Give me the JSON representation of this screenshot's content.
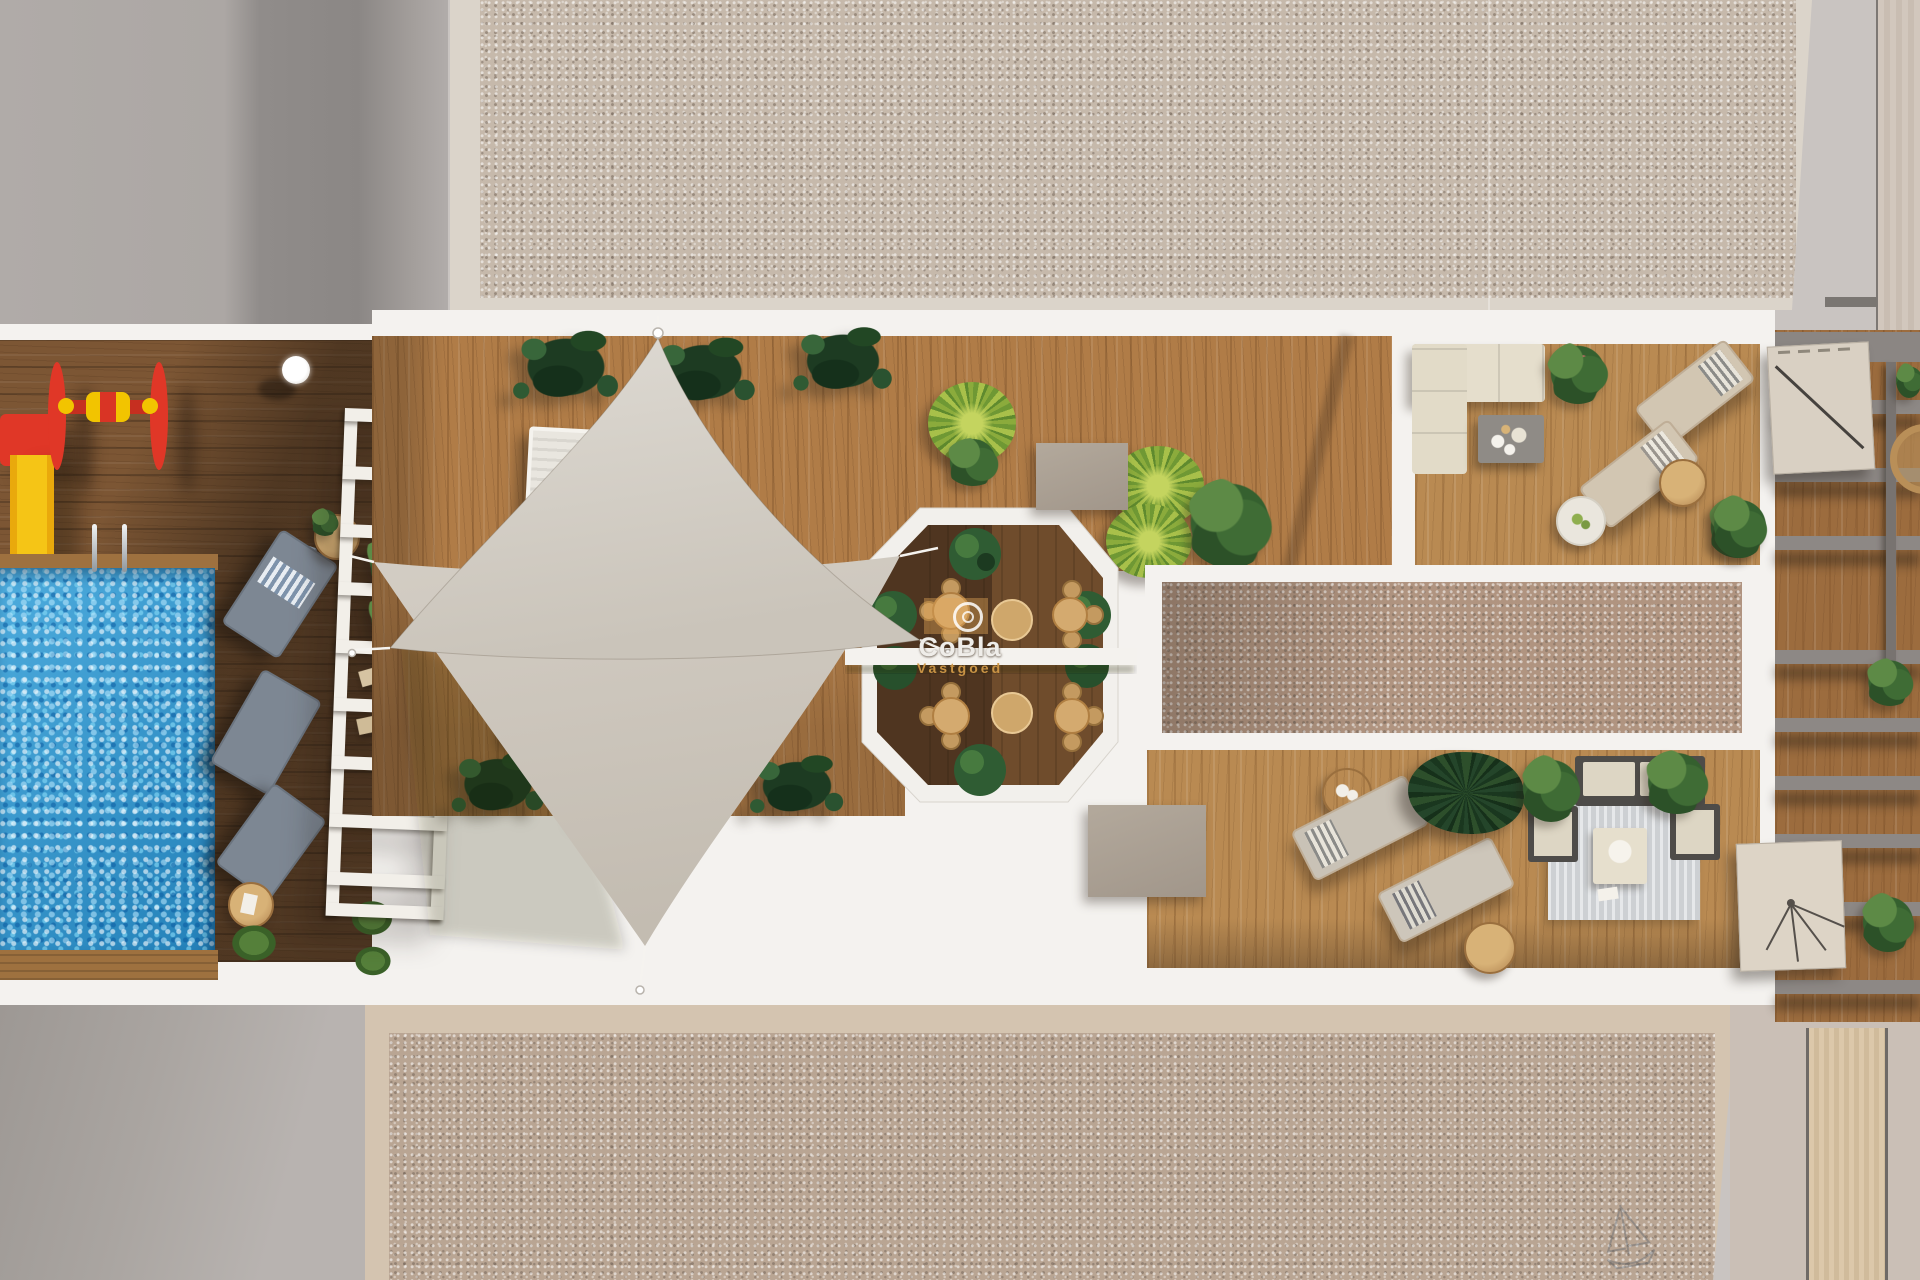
{
  "watermark": {
    "brand": "CoBla",
    "subtitle": "Vastgoed"
  },
  "icons": {
    "sailboat": "sailboat-sketch",
    "logo_swirl": "spiral-logo"
  },
  "scene": {
    "type": "aerial-3d-architectural-render",
    "areas": [
      "communal rooftop terrace",
      "swimming pool",
      "children playground",
      "shade sails sun deck",
      "octagonal light well with dining tables",
      "skylight strip",
      "lounge corner with sofa",
      "sunbed zone",
      "private pergola terraces",
      "gravel roofs"
    ]
  },
  "colors": {
    "path_base": "#c9c4c1",
    "parapet": "#f4f2ef",
    "gravel_top": "#c6b9ab",
    "gravel_bottom": "#b9a593",
    "gravel_skylight": "#b09480",
    "deck_mid": "#b07c47",
    "deck_dark": "#7c5634",
    "pool": "#2f9ed8",
    "sail_light": "#dedad3",
    "sail_dark": "#c3bcb1",
    "taupe": "#a1968a",
    "play_red": "#e03727",
    "play_yellow": "#f2c400",
    "wm_orange": "#cf9847"
  }
}
